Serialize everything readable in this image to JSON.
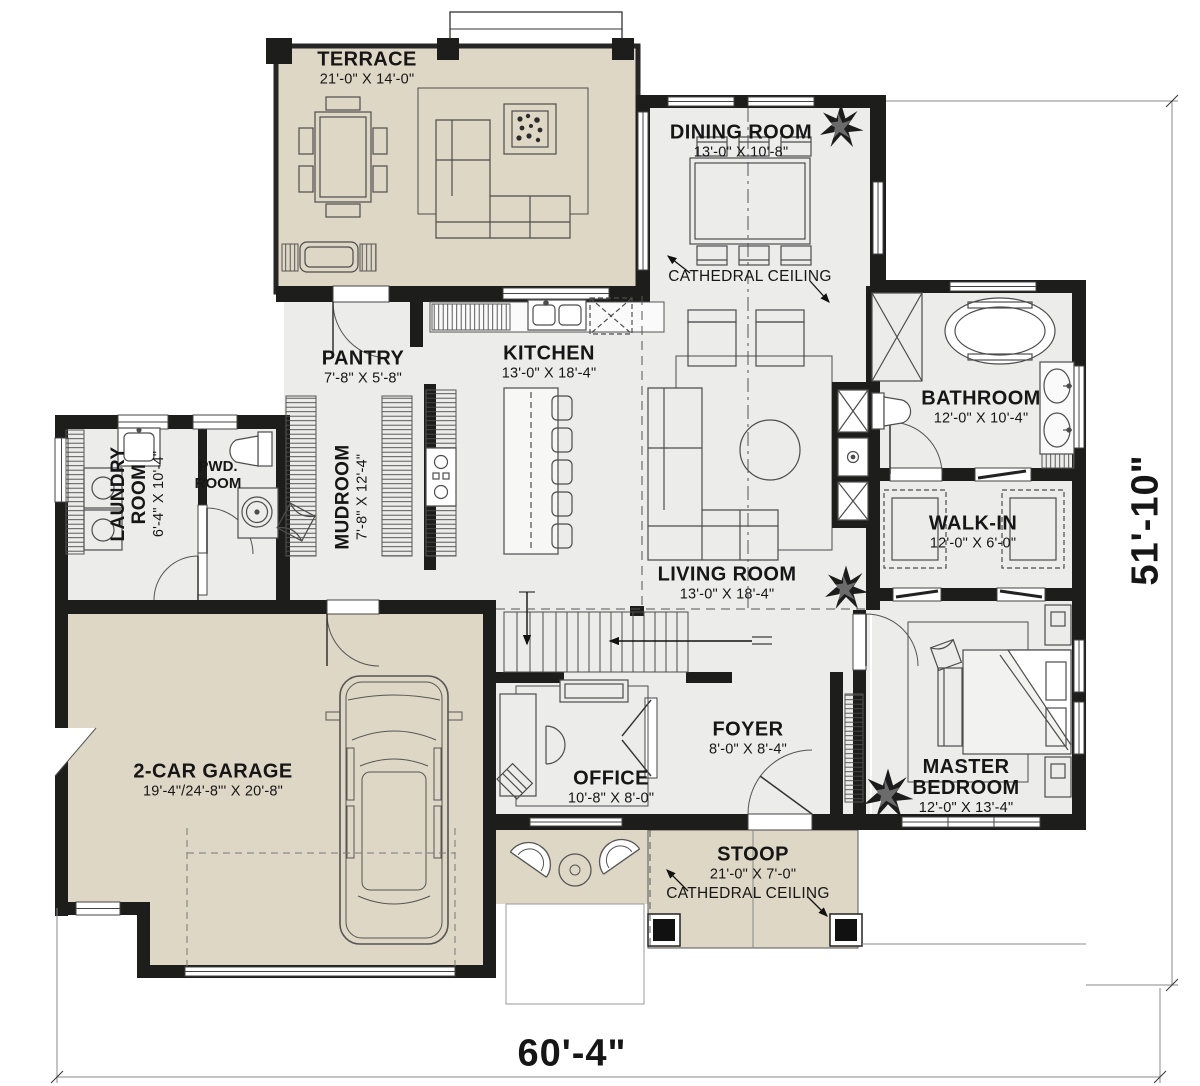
{
  "rooms": {
    "terrace": {
      "name": "TERRACE",
      "dims": "21'-0\" X 14'-0\""
    },
    "dining_room": {
      "name": "DINING ROOM",
      "dims": "13'-0\" X 10'-8\""
    },
    "pantry": {
      "name": "PANTRY",
      "dims": "7'-8\" X 5'-8\""
    },
    "kitchen": {
      "name": "KITCHEN",
      "dims": "13'-0\" X 18'-4\""
    },
    "mudroom": {
      "name": "MUDROOM",
      "dims": "7'-8\" X 12'-4\""
    },
    "laundry_room": {
      "name": "LAUNDRY ROOM",
      "dims": "6'-4\" X 10'-4\""
    },
    "powder_room": {
      "name": "PWD. ROOM",
      "dims": ""
    },
    "bathroom": {
      "name": "BATHROOM",
      "dims": "12'-0\" X 10'-4\""
    },
    "walk_in": {
      "name": "WALK-IN",
      "dims": "12'-0\" X 6'-0\""
    },
    "living_room": {
      "name": "LIVING ROOM",
      "dims": "13'-0\" X 18'-4\""
    },
    "master_bedroom": {
      "name": "MASTER BEDROOM",
      "dims": "12'-0\" X 13'-4\""
    },
    "office": {
      "name": "OFFICE",
      "dims": "10'-8\" X 8'-0\""
    },
    "foyer": {
      "name": "FOYER",
      "dims": "8'-0\" X 8'-4\""
    },
    "garage": {
      "name": "2-CAR GARAGE",
      "dims": "19'-4\"/24'-8\"' X 20'-8\""
    },
    "stoop": {
      "name": "STOOP",
      "dims": "21'-0\" X 7'-0\""
    }
  },
  "annotations": {
    "cathedral_ceiling_dining": "CATHEDRAL CEILING",
    "cathedral_ceiling_stoop": "CATHEDRAL CEILING"
  },
  "overall_dimensions": {
    "width": "60'-4\"",
    "height": "51'-10\""
  },
  "colors": {
    "wall": "#1d1d1b",
    "indoor_floor": "#ececeb",
    "outdoor_floor": "#ded7c6",
    "paper": "#ffffff"
  }
}
